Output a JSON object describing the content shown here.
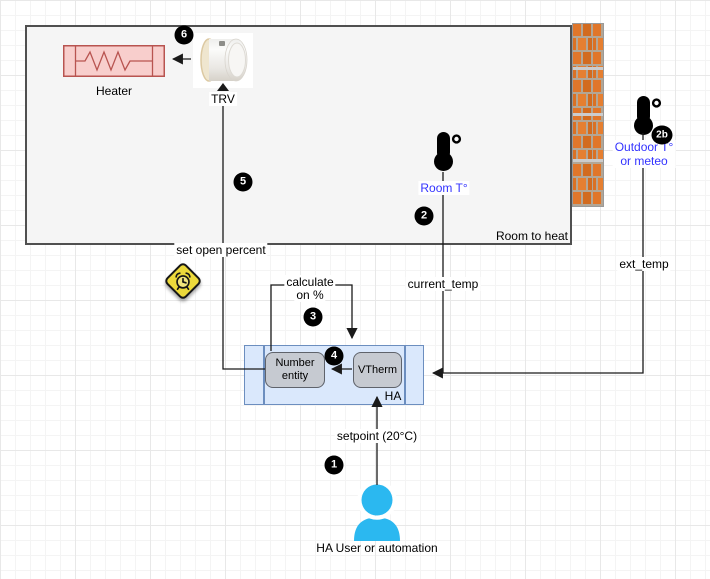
{
  "diagram": {
    "room": {
      "label": "Room to heat"
    },
    "nodes": {
      "heater": {
        "label": "Heater"
      },
      "trv": {
        "label": "TRV"
      },
      "room_sensor": {
        "label": "Room T°"
      },
      "outdoor_sensor": {
        "label_line1": "Outdoor T°",
        "label_line2": "or meteo"
      },
      "ha_container": {
        "label": "HA"
      },
      "number_entity": {
        "label": "Number entity"
      },
      "vtherm": {
        "label": "VTherm"
      },
      "user": {
        "label": "HA User or automation"
      }
    },
    "edges": {
      "set_open_percent": {
        "label": "set open percent"
      },
      "calculate": {
        "label_line1": "calculate",
        "label_line2": "on %"
      },
      "current_temp": {
        "label": "current_temp"
      },
      "ext_temp": {
        "label": "ext_temp"
      },
      "setpoint": {
        "label": "setpoint (20°C)"
      }
    },
    "badges": {
      "step1": "1",
      "step2": "2",
      "step2b": "2b",
      "step3": "3",
      "step4": "4",
      "step5": "5",
      "step6": "6"
    },
    "colors": {
      "heater_fill": "#f8cecc",
      "heater_stroke": "#b85450",
      "ha_fill": "#dae8fc",
      "ha_stroke": "#6c8ebf",
      "entity_fill": "#c6cad1",
      "entity_stroke": "#5f636b",
      "sensor_label_blue": "#3333ff",
      "user_blue": "#2bb8f0",
      "alarm_yellow": "#ecd93b",
      "brick_orange": "#e0762a",
      "badge_black": "#000000"
    }
  }
}
